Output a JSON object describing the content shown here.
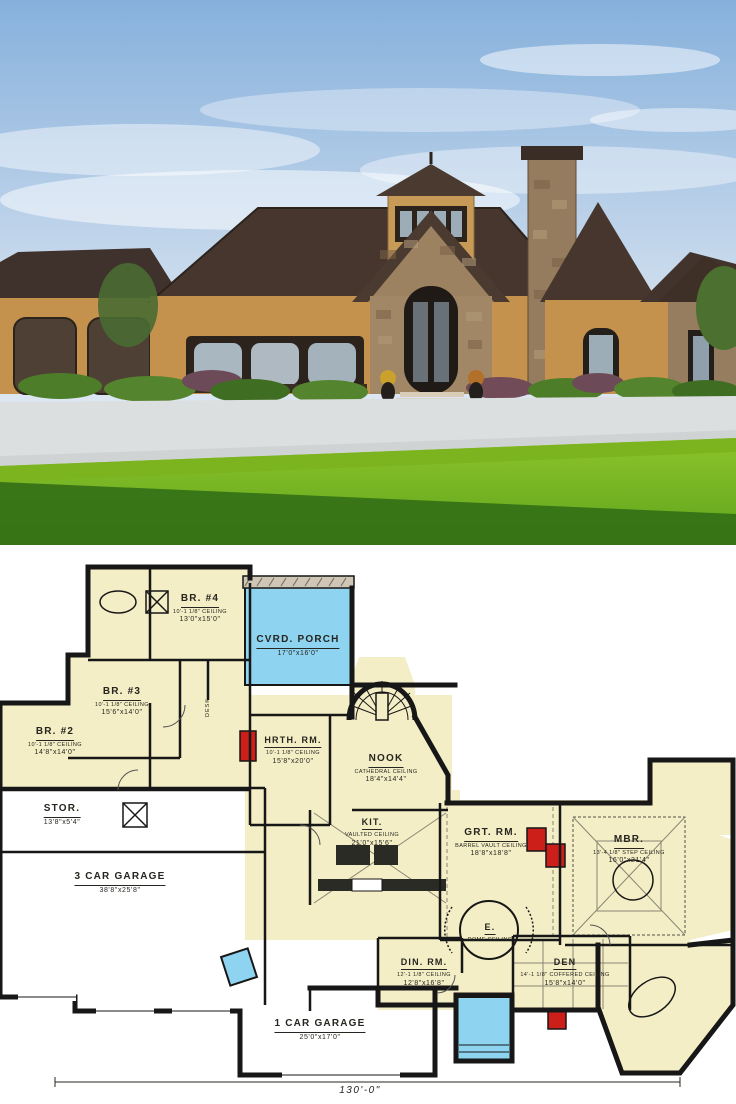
{
  "photo": {
    "description": "Tuscan-style stucco and stone one-story home with central round turret, arched stone entry, stone chimney, triple arched windows, two arched garage doors and a wide green lawn under a blue sky",
    "colors": {
      "sky_top": "#86b0dc",
      "sky_low": "#eef3f7",
      "roof": "#46362e",
      "stucco": "#c4924c",
      "stone": "#977d5f",
      "trim": "#2c231d",
      "glass": "#a9b7c0",
      "grass_bright": "#7cb41f",
      "grass_shadow": "#2f6b15",
      "driveway": "#dcdfe0"
    }
  },
  "plan": {
    "colors": {
      "paper": "#ffffff",
      "wall": "#171717",
      "room_fill": "#f4eec6",
      "porch_fill": "#8ed3ef",
      "fireplace": "#cc1f1a"
    },
    "rooms": [
      {
        "id": "br4",
        "name": "BR. #4",
        "ceiling": "10'-1 1/8\" CEILING",
        "dims": "13'0\"x15'0\""
      },
      {
        "id": "porch",
        "name": "CVRD. PORCH",
        "ceiling": "",
        "dims": "17'0\"x16'0\""
      },
      {
        "id": "br3",
        "name": "BR. #3",
        "ceiling": "10'-1 1/8\" CEILING",
        "dims": "15'6\"x14'0\""
      },
      {
        "id": "br2",
        "name": "BR. #2",
        "ceiling": "10'-1 1/8\" CEILING",
        "dims": "14'8\"x14'0\""
      },
      {
        "id": "stor",
        "name": "STOR.",
        "ceiling": "",
        "dims": "13'8\"x5'4\""
      },
      {
        "id": "garage3",
        "name": "3 CAR GARAGE",
        "ceiling": "",
        "dims": "38'8\"x25'8\""
      },
      {
        "id": "hrth",
        "name": "HRTH. RM.",
        "ceiling": "10'-1 1/8\" CEILING",
        "dims": "15'8\"x20'0\""
      },
      {
        "id": "nook",
        "name": "NOOK",
        "ceiling": "CATHEDRAL CEILING",
        "dims": "18'4\"x14'4\""
      },
      {
        "id": "kit",
        "name": "KIT.",
        "ceiling": "VAULTED CEILING",
        "dims": "21'0\"x15'6\""
      },
      {
        "id": "grt",
        "name": "GRT. RM.",
        "ceiling": "BARREL VAULT CEILING",
        "dims": "18'8\"x18'8\""
      },
      {
        "id": "mbr",
        "name": "MBR.",
        "ceiling": "13'-4 1/8\" STEP CEILING",
        "dims": "16'0\"x21'4\""
      },
      {
        "id": "entry",
        "name": "E.",
        "ceiling": "DOME CEILING",
        "dims": ""
      },
      {
        "id": "din",
        "name": "DIN. RM.",
        "ceiling": "12'-1 1/8\" CEILING",
        "dims": "12'8\"x16'8\""
      },
      {
        "id": "den",
        "name": "DEN",
        "ceiling": "14'-1 1/8\" COFFERED CEILING",
        "dims": "15'8\"x14'0\""
      },
      {
        "id": "garage1",
        "name": "1 CAR GARAGE",
        "ceiling": "",
        "dims": "25'0\"x17'0\""
      }
    ],
    "annotations": {
      "desk": "DESK",
      "overall_width": "130'-0\""
    }
  }
}
